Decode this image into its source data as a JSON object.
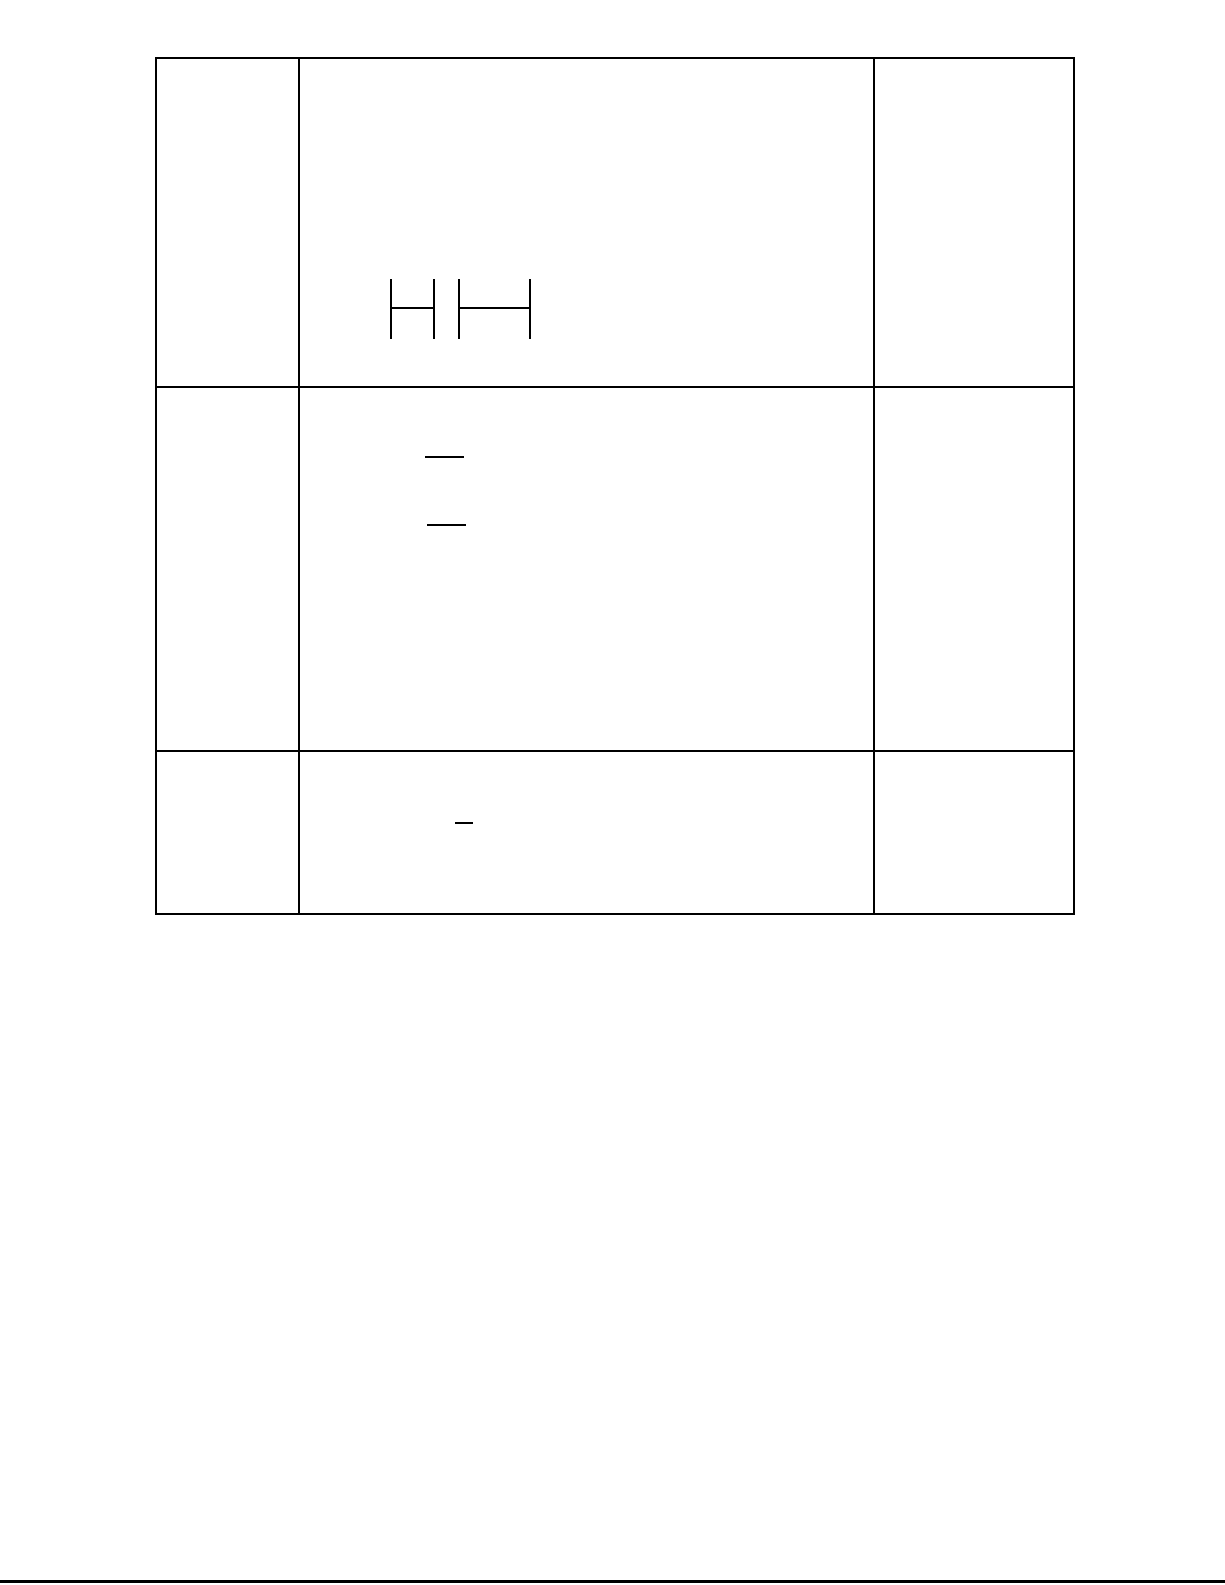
{
  "page": {
    "width": 1225,
    "height": 1585,
    "background_color": "#ffffff",
    "ink_color": "#000000"
  },
  "table": {
    "rows": 3,
    "cols": 3,
    "x": 155,
    "y": 57,
    "right": 1075,
    "bottom": 915,
    "column_boundaries_x": [
      155,
      300,
      877,
      1075
    ],
    "row_boundaries_y": [
      57,
      388,
      754,
      913
    ],
    "border_color": "#000000",
    "cells": [
      [
        "",
        "",
        ""
      ],
      [
        "",
        "",
        ""
      ],
      [
        "",
        "",
        ""
      ]
    ]
  },
  "line_groups": [
    {
      "name": "capacitor-series-symbol",
      "description": "two capacitor-like H glyphs drawn in row 1 middle cell",
      "color": "#000000",
      "thickness": 2,
      "lines": [
        [
          390,
          279,
          390,
          339
        ],
        [
          433,
          279,
          433,
          339
        ],
        [
          390,
          307,
          435,
          307
        ],
        [
          458,
          279,
          458,
          339
        ],
        [
          529,
          279,
          529,
          339
        ],
        [
          458,
          307,
          531,
          307
        ]
      ]
    },
    {
      "name": "row2-blank-fraction-bars",
      "description": "two short horizontal blank bars in row 2 middle cell",
      "color": "#000000",
      "thickness": 2,
      "lines": [
        [
          425,
          456,
          464,
          456
        ],
        [
          427,
          524,
          466,
          524
        ]
      ]
    },
    {
      "name": "row3-blank-bar",
      "description": "one short horizontal blank bar in row 3 middle cell",
      "color": "#000000",
      "thickness": 2,
      "lines": [
        [
          455,
          822,
          473,
          822
        ]
      ]
    },
    {
      "name": "page-bottom-rule",
      "description": "black rule across the very bottom edge of the page",
      "color": "#000000",
      "thickness": 3,
      "lines": [
        [
          0,
          1580,
          1225,
          1580
        ]
      ]
    }
  ]
}
